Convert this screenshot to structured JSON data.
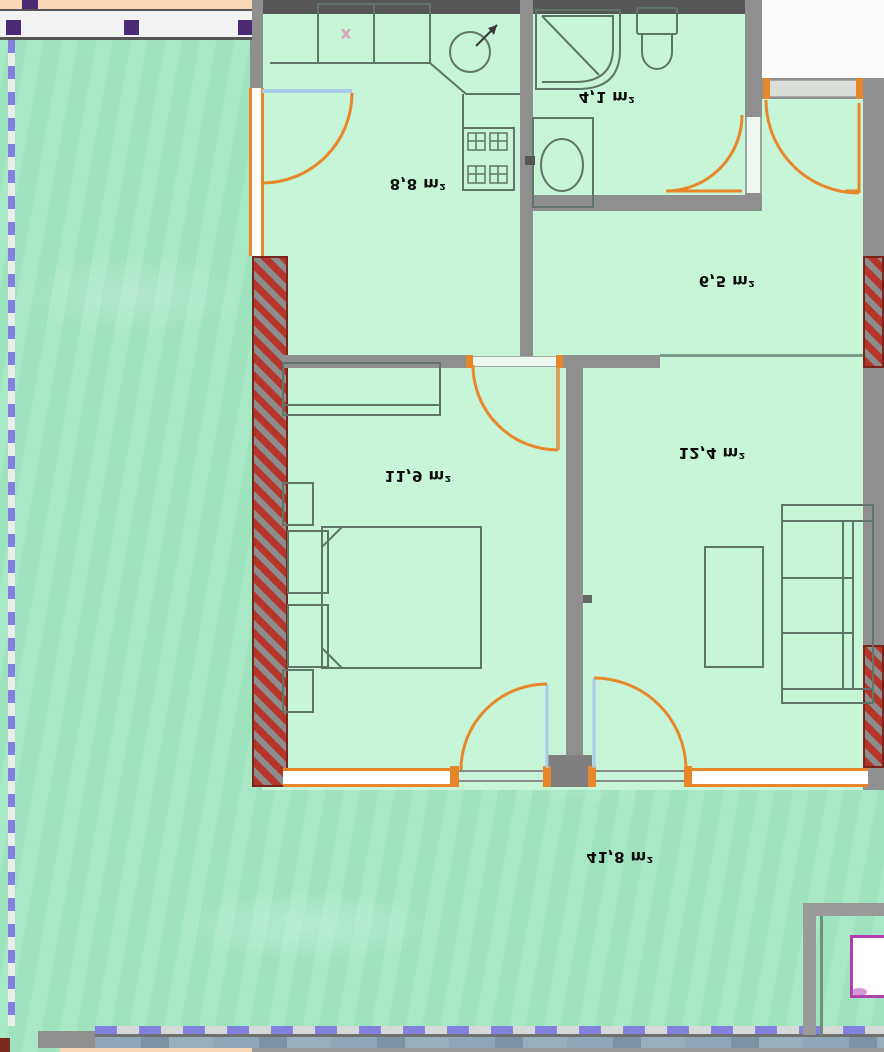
{
  "plan": {
    "type": "apartment-floor-plan",
    "note": "plan rendered vertically mirrored; area labels appear upside-down",
    "rooms": [
      {
        "name": "kitchen",
        "area": "8,8 m²"
      },
      {
        "name": "bathroom",
        "area": "4,1 m²"
      },
      {
        "name": "hall",
        "area": "6,5 m²"
      },
      {
        "name": "bedroom",
        "area": "11,9 m²"
      },
      {
        "name": "living-room",
        "area": "12,4 m²"
      },
      {
        "name": "terrace",
        "area": "41,8 m²"
      }
    ],
    "markers": {
      "kitchen_appliance_mark": "x"
    },
    "colors": {
      "room_fill": "#c6f5d8",
      "terrace_fill": "#a4e7c4",
      "wall_gray": "#8f8f8f",
      "wall_dark": "#575757",
      "masonry_red": "#b5352a",
      "door_orange": "#e8872a",
      "glazed_leaf_blue": "#a9cce8",
      "railing_post_purple": "#4a2a72",
      "dashed_border_purple": "#8282de",
      "accent_magenta": "#b040b0",
      "label_text": "#0c0c0c"
    }
  }
}
